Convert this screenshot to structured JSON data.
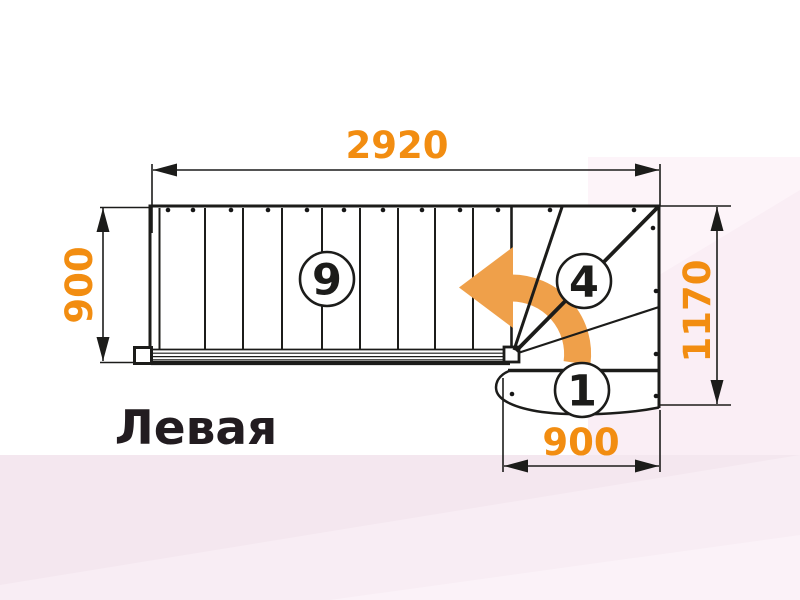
{
  "title": "Левая",
  "dimensions": {
    "top_width": "2920",
    "left_depth": "900",
    "right_depth": "1170",
    "bottom_width": "900"
  },
  "step_labels": {
    "straight_flight_step": "9",
    "winder_step": "4",
    "first_step": "1"
  },
  "icons": {
    "turn_arrow": "curved-left-turn-arrow"
  },
  "colors": {
    "dimension_text": "#f28d11",
    "arrow_fill": "#efa04a",
    "line": "#1c1c1a"
  }
}
